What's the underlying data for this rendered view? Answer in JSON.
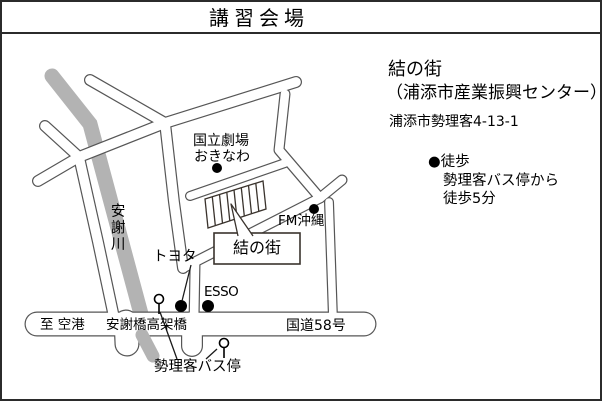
{
  "title": "講習会場",
  "info_panel": {
    "venue_name": "結の街",
    "venue_subtitle": "（浦添市産業振興センター）",
    "address": "浦添市勢理客4-13-1",
    "access_bullet": "●徒歩",
    "access_line1": "勢理客バス停から",
    "access_line2": "徒歩5分"
  },
  "map": {
    "labels": {
      "theater_line1": "国立劇場",
      "theater_line2": "おきなわ",
      "fm_okinawa": "FM沖縄",
      "toyota": "トヨタ",
      "esso": "ESSO",
      "venue_box": "結の街",
      "river": "安謝川",
      "to_airport": "至 空港",
      "bridge": "安謝橋高架橋",
      "route_58": "国道58号",
      "bus_stop": "勢理客バス停"
    },
    "colors": {
      "river": "#b3b3b3",
      "road_outline": "#565656",
      "road_fill": "#ffffff",
      "detail_stroke": "#3a332d",
      "marker": "#000000"
    }
  }
}
